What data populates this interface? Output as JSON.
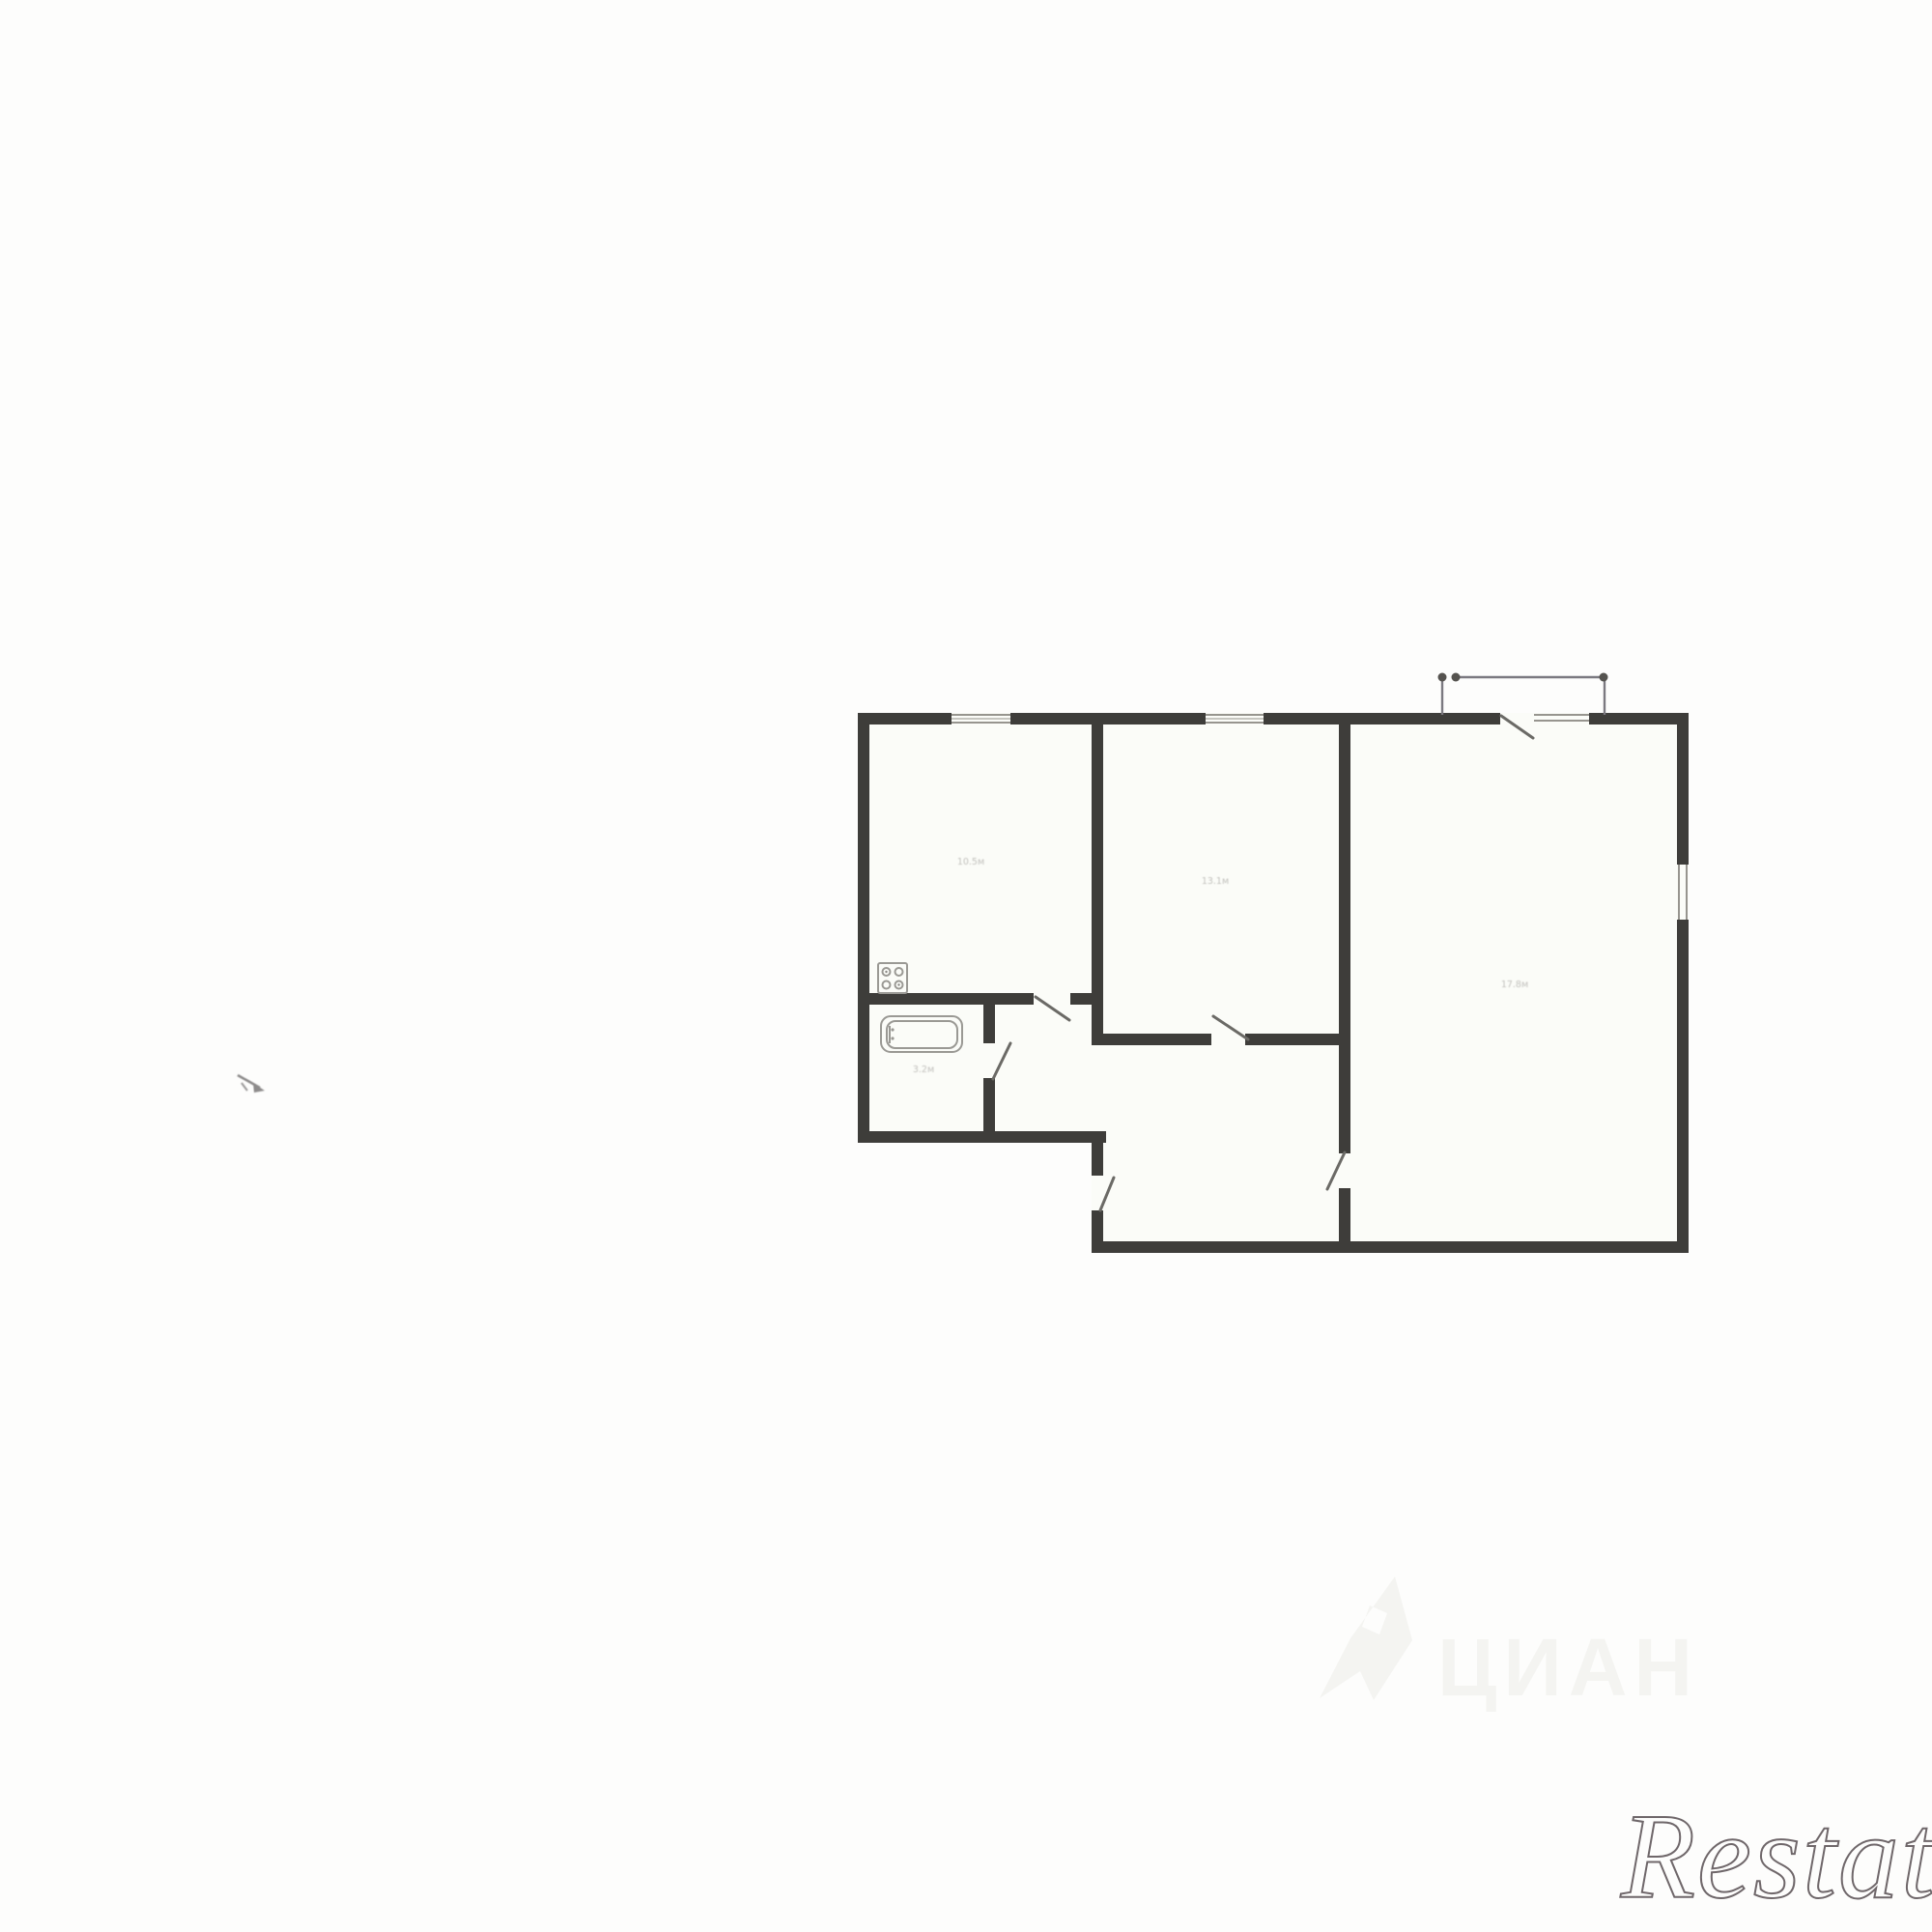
{
  "floor_plan": {
    "wall_color": "#3e3d3a",
    "window_line_color": "#97958f",
    "door_leaf_color": "#6b6a66",
    "fixture_line_color": "#9a9994",
    "room_label_color": "#c2c1bd",
    "rooms": [
      {
        "id": "kitchen",
        "area_label": "10.5м"
      },
      {
        "id": "room-2",
        "area_label": "13.1м"
      },
      {
        "id": "room-3",
        "area_label": "17.8м"
      },
      {
        "id": "bathroom",
        "area_label": "3.2м"
      }
    ],
    "fixtures": [
      {
        "id": "stove"
      },
      {
        "id": "bathtub"
      }
    ],
    "annotations": [
      {
        "id": "balcony-railing"
      },
      {
        "id": "north-arrow"
      }
    ]
  },
  "watermarks": {
    "cian": {
      "text": "ЦИАН",
      "color": "#f4f4f1"
    },
    "restate": {
      "text": "Restate",
      "stroke_color": "#6f676a"
    }
  }
}
